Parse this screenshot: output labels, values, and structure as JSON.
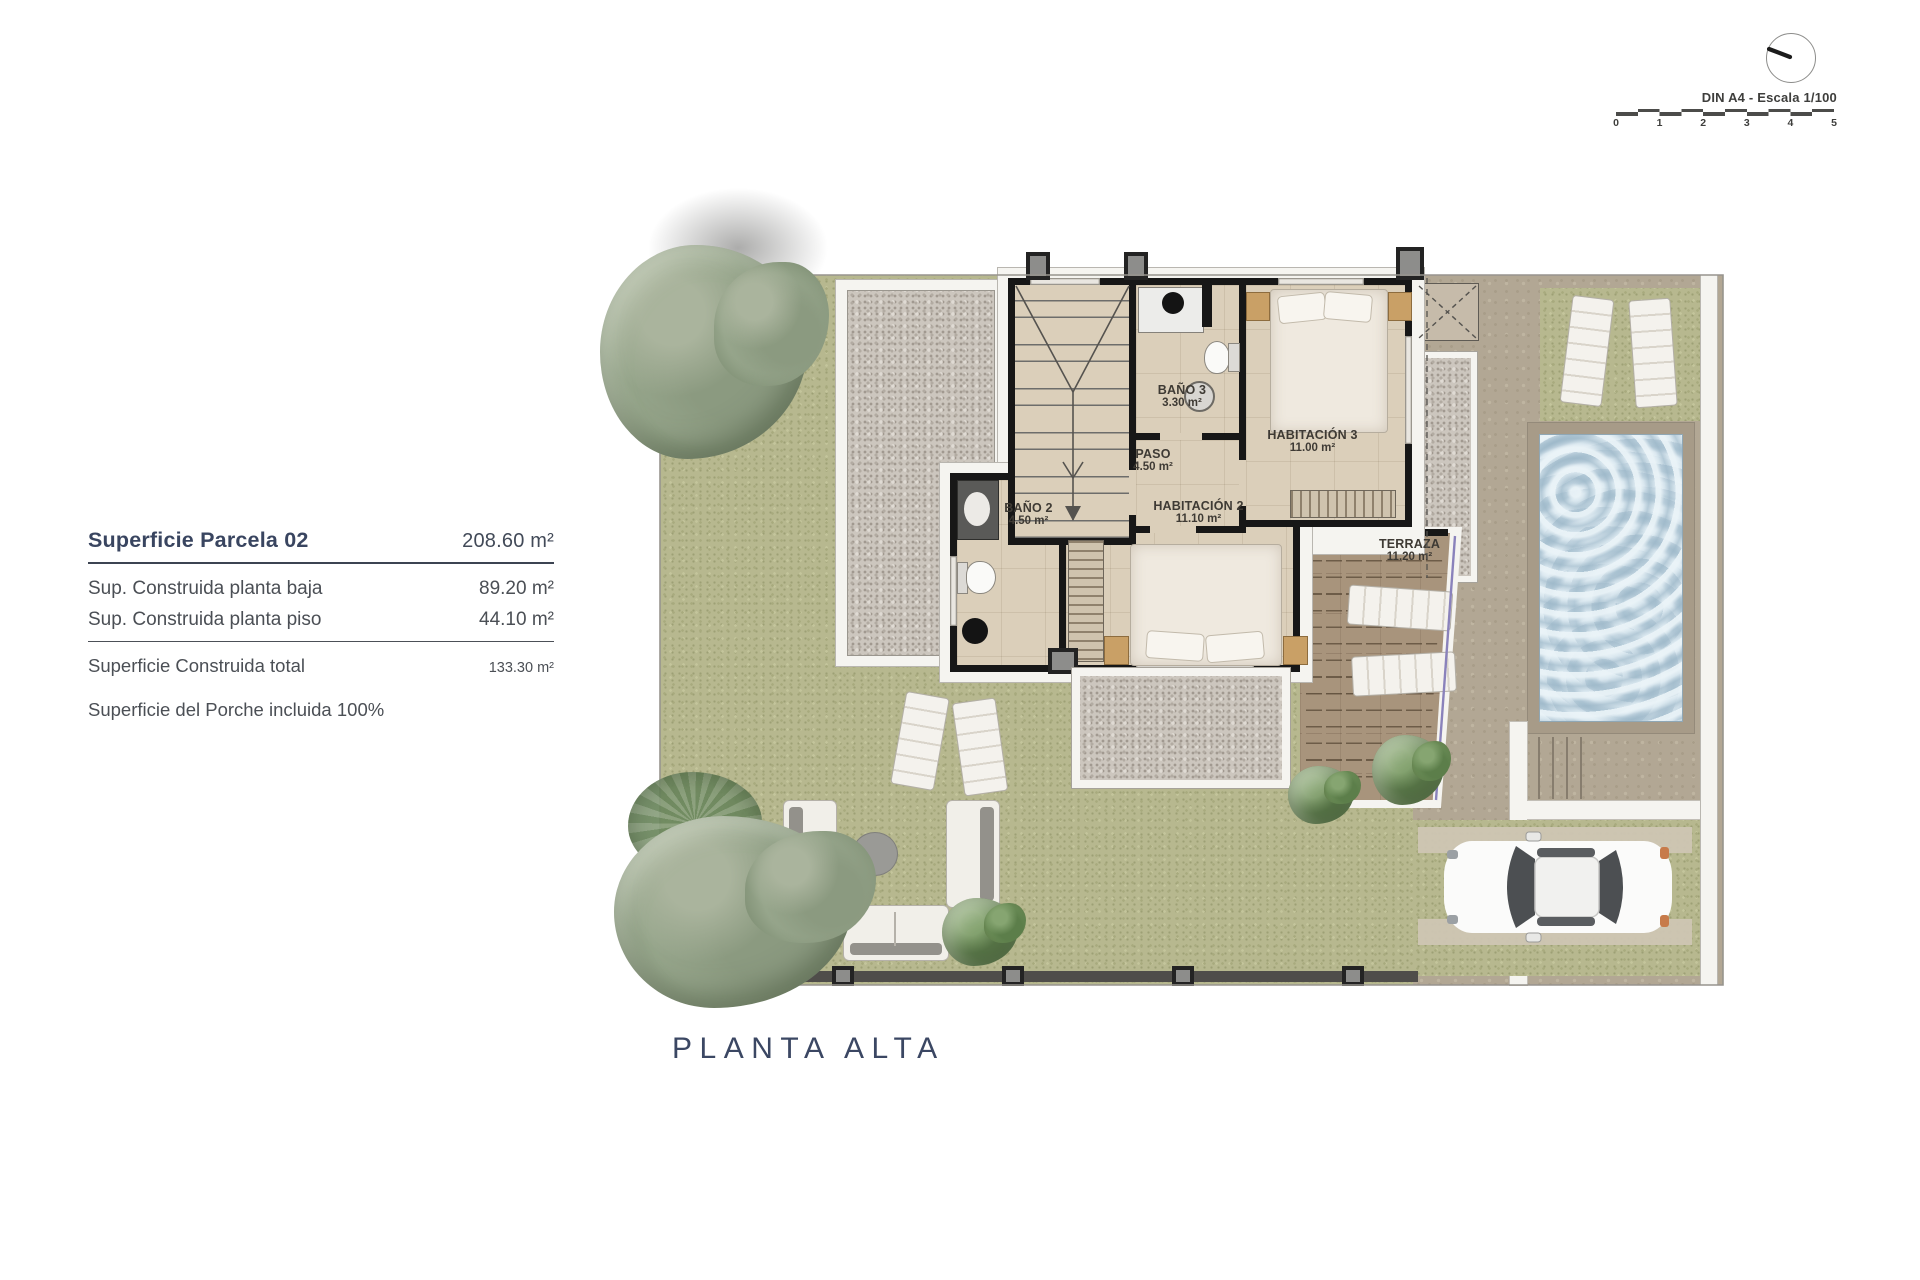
{
  "scale_indicator": {
    "label": "DIN A4 - Escala 1/100",
    "ticks": [
      "0",
      "1",
      "2",
      "3",
      "4",
      "5"
    ]
  },
  "info_panel": {
    "parcel": {
      "label": "Superficie Parcela 02",
      "value": "208.60 m²"
    },
    "rows": [
      {
        "label": "Sup. Construida planta baja",
        "value": "89.20 m²"
      },
      {
        "label": "Sup. Construida planta piso",
        "value": "44.10 m²"
      }
    ],
    "total": {
      "label": "Superficie Construida total",
      "value": "133.30 m²"
    },
    "note": "Superficie del Porche incluida 100%"
  },
  "floor_plan": {
    "caption": "PLANTA ALTA",
    "rooms": [
      {
        "name": "BAÑO 3",
        "area": "3.30 m²"
      },
      {
        "name": "PASO",
        "area": "4.50 m²"
      },
      {
        "name": "HABITACIÓN 3",
        "area": "11.00 m²"
      },
      {
        "name": "BAÑO 2",
        "area": "4.50 m²"
      },
      {
        "name": "HABITACIÓN 2",
        "area": "11.10 m²"
      },
      {
        "name": "TERRAZA",
        "area": "11.20 m²"
      }
    ]
  },
  "colors": {
    "navy_text": "#394560",
    "gray_text": "#4b4f55",
    "grass": "#b7b88f",
    "gravel": "#ccc6be",
    "room_floor": "#dbcfba",
    "terrace_floor": "#a8947c",
    "pool_water": "#c2d4e0",
    "pavement": "#b2a794",
    "wall": "#171717"
  }
}
